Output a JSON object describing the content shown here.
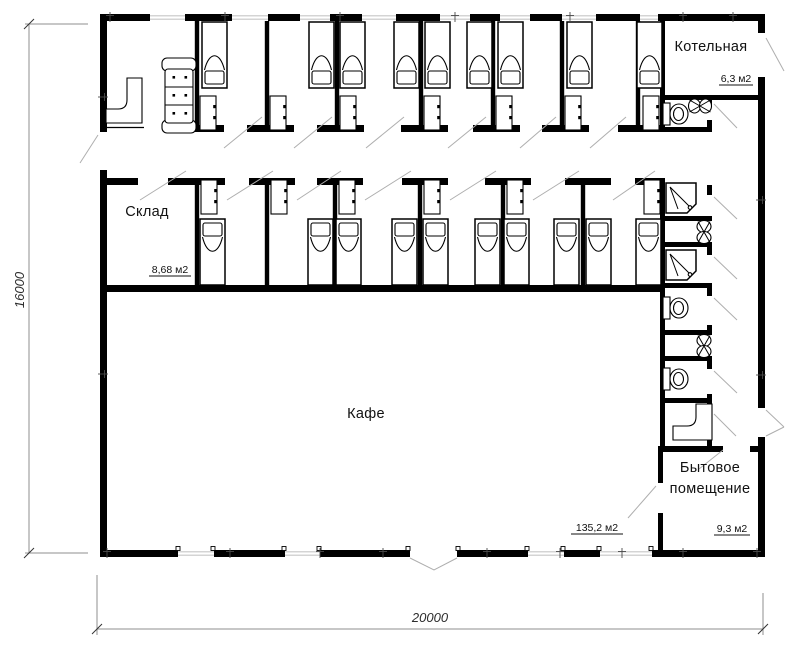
{
  "rooms": {
    "boiler": {
      "label": "Котельная",
      "area": "6,3 м2"
    },
    "storage": {
      "label": "Склад",
      "area": "8,68 м2"
    },
    "cafe": {
      "label": "Кафе",
      "area": "135,2 м2"
    },
    "utility": {
      "label_line1": "Бытовое",
      "label_line2": "помещение",
      "area": "9,3 м2"
    }
  },
  "dimensions": {
    "height": "16000",
    "width": "20000"
  },
  "colors": {
    "walls": "#000000",
    "windows": "#c6c6c6",
    "door_marks": "#aeaeae",
    "dimension_lines": "#8f8f8f",
    "background": "#ffffff"
  }
}
